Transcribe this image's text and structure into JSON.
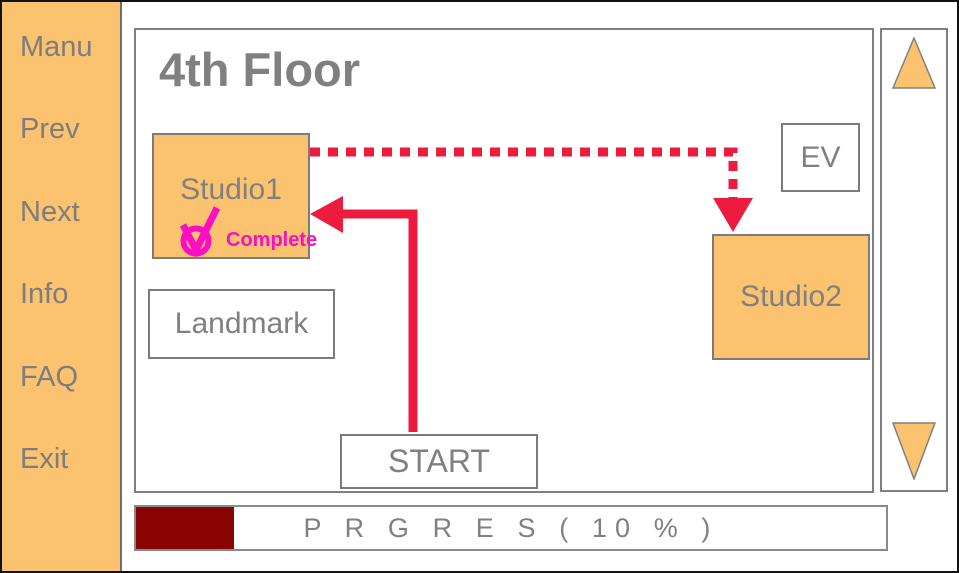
{
  "colors": {
    "accent_orange": "#FBC270",
    "route_red": "#ED1B3E",
    "complete_magenta": "#FB0FC4",
    "progress_maroon": "#8B0404",
    "text_gray": "#808080"
  },
  "sidebar": {
    "items": [
      {
        "label": "Manu"
      },
      {
        "label": "Prev"
      },
      {
        "label": "Next"
      },
      {
        "label": "Info"
      },
      {
        "label": "FAQ"
      },
      {
        "label": "Exit"
      }
    ]
  },
  "map": {
    "title": "4th Floor",
    "rooms": {
      "studio1": {
        "label": "Studio1",
        "status": "Complete"
      },
      "landmark": {
        "label": "Landmark"
      },
      "ev": {
        "label": "EV"
      },
      "studio2": {
        "label": "Studio2"
      },
      "start": {
        "label": "START"
      }
    },
    "route": {
      "solid_arrow": "START to Studio1",
      "dashed_arrow": "Studio1 to Studio2"
    }
  },
  "progress": {
    "label": "P R G R E S ( 10 % )",
    "percent": 10,
    "fill_style": "width:13.1%"
  }
}
